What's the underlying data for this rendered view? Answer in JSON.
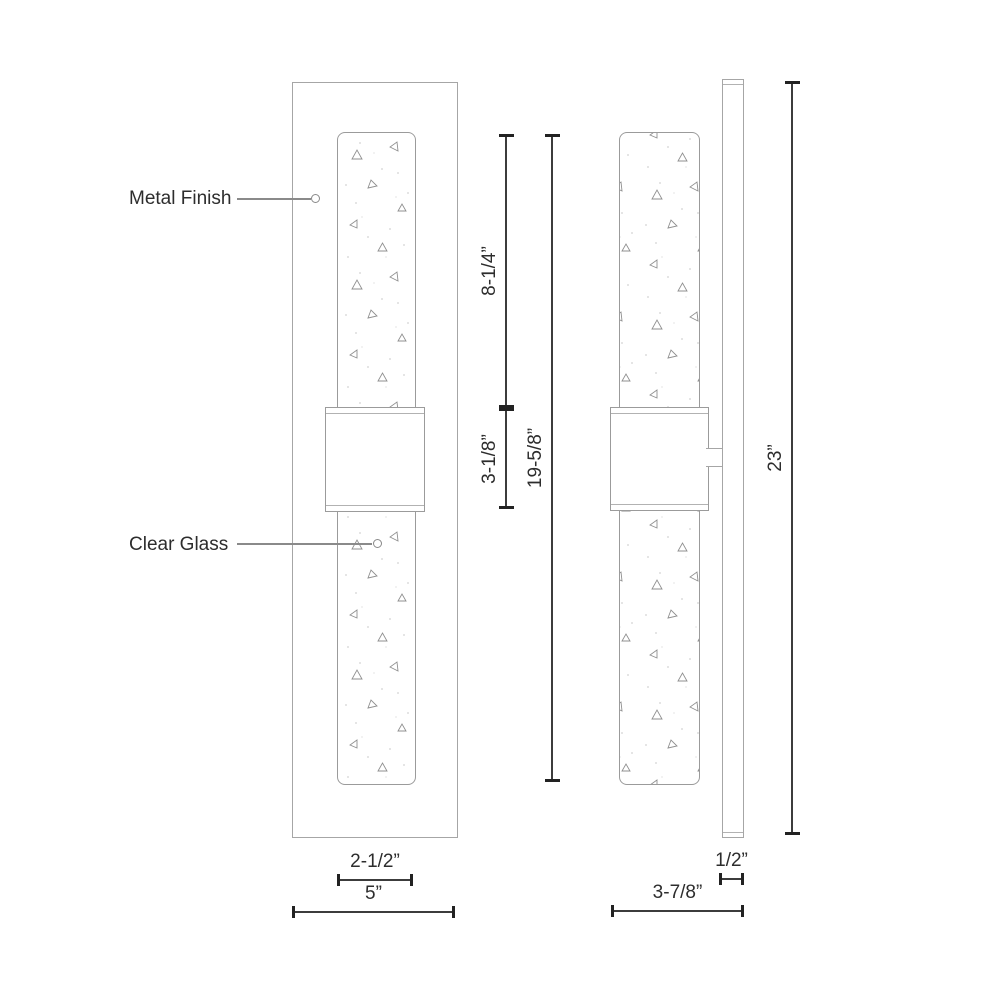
{
  "labels": {
    "metal_finish": "Metal Finish",
    "clear_glass": "Clear Glass"
  },
  "dimensions": {
    "upper_glass_height": "8-1/4”",
    "center_band_height": "3-1/8”",
    "glass_overall_height": "19-5/8”",
    "overall_height": "23”",
    "glass_width": "2-1/2”",
    "backplate_width": "5”",
    "backplate_depth": "1/2”",
    "overall_depth": "3-7/8”"
  },
  "colors": {
    "fixture_outline": "#a6a6a6",
    "glass_outline": "#9b9b9b",
    "dimension_line": "#3c3c3c",
    "dimension_tick": "#222222",
    "leader_line": "#8a8a8a",
    "text": "#2d2d2d",
    "background": "#ffffff"
  }
}
